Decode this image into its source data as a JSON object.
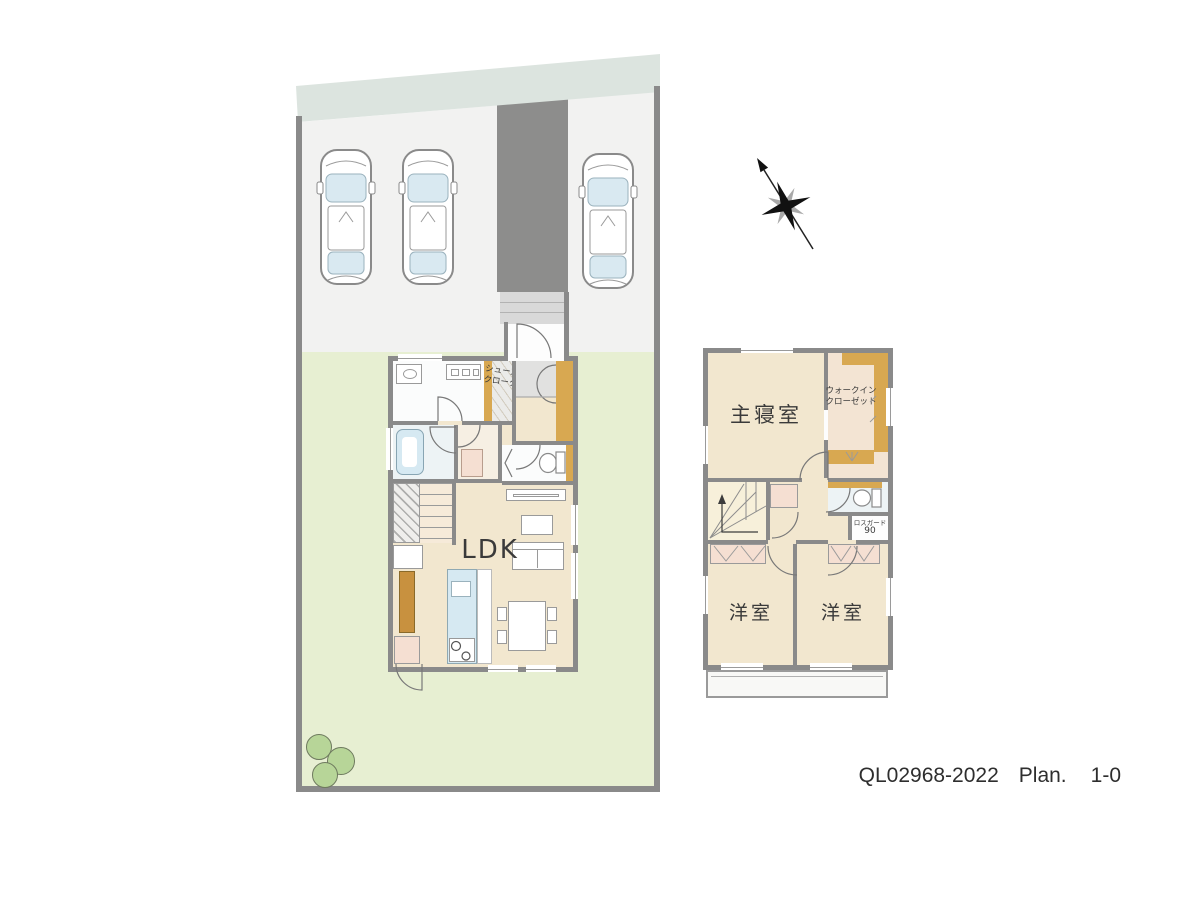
{
  "colors": {
    "wall": "#8a8a8a",
    "floor": "#f2e7cf",
    "floor_light": "#f6efe3",
    "lawn": "#e7efd2",
    "road": "#dce4df",
    "parking": "#f2f2f1",
    "driveway": "#8d8d8c",
    "porch": "#d9d9d9",
    "orange": "#d8a851",
    "orange_dark": "#c8913f",
    "pink": "#f5dfd2",
    "blue": "#d6e9f2",
    "white_room": "#fbfcfc",
    "stairs2f": "#f7f0da",
    "bush": "#b7d598",
    "text": "#3a3a3a"
  },
  "floor1": {
    "ldk": "LDK",
    "shoes_closet": [
      "シューズ",
      "クローク"
    ]
  },
  "floor2": {
    "master_bedroom": "主寝室",
    "walk_in_closet": [
      "ウォークイン",
      "クローゼット"
    ],
    "western_room_1": "洋室",
    "western_room_2": "洋室",
    "lossguard": [
      "ロスガード",
      "90"
    ]
  },
  "footer": {
    "code": "QL02968-2022",
    "plan_word": "Plan.",
    "plan_number": "1-0"
  }
}
